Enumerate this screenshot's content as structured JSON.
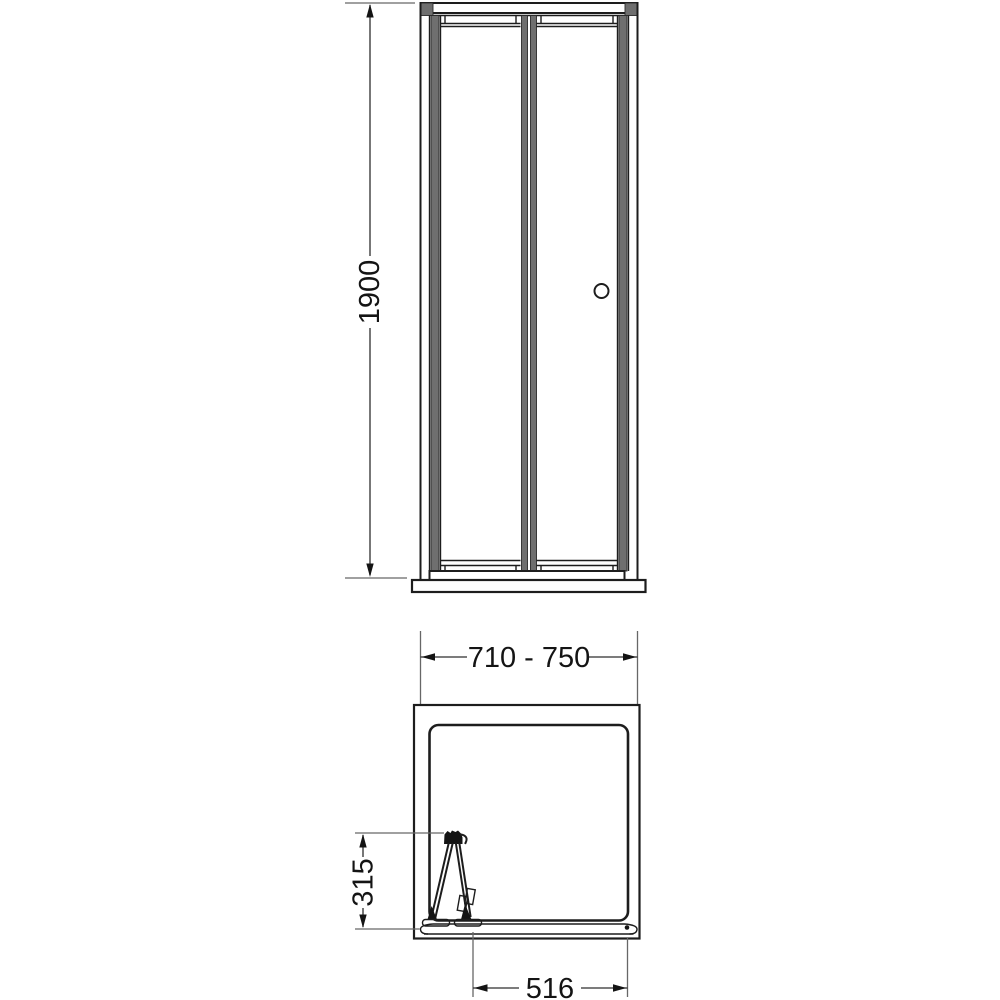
{
  "drawing": {
    "background_color": "#ffffff",
    "line_color": "#1d1d1d",
    "frame_profile_fill": "#6f6f6f",
    "extension_line_color": "#676767",
    "dimensions": {
      "overall_height": "1900",
      "overall_width_range": "710 - 750",
      "folded_door_projection": "315",
      "clear_opening": "516"
    }
  }
}
